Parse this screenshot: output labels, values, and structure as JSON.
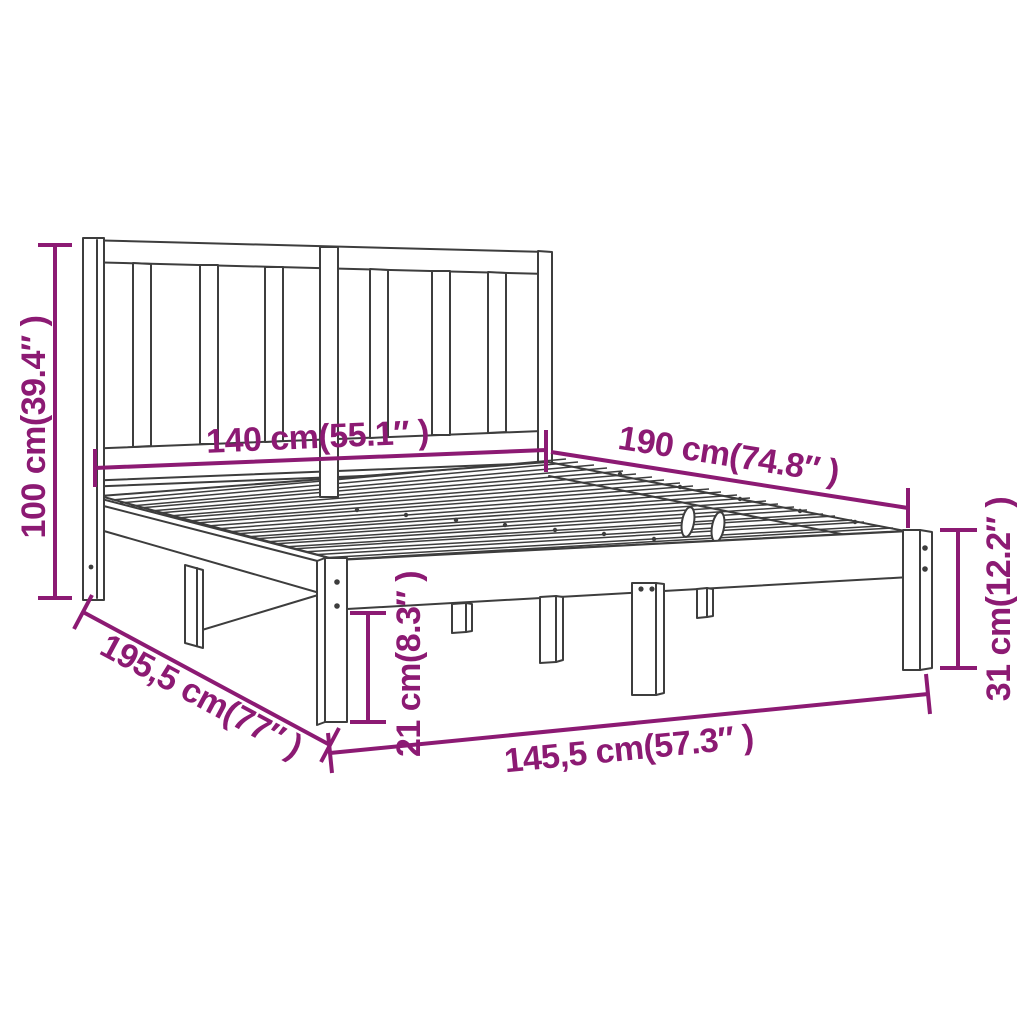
{
  "colors": {
    "background": "#FFFFFF",
    "line_art": "#3D3D3D",
    "dimension_annotations": "#8C1A73"
  },
  "dimensions": {
    "total_height": "100 cm(39.4″ )",
    "headboard_width": "140 cm(55.1″ )",
    "mattress_length": "190 cm(74.8″ )",
    "side_height": "31 cm(12.2″ )",
    "under_bed_clearance": "21 cm(8.3″ )",
    "total_length": "195,5 cm(77″ )",
    "total_width": "145,5 cm(57.3″ )"
  }
}
